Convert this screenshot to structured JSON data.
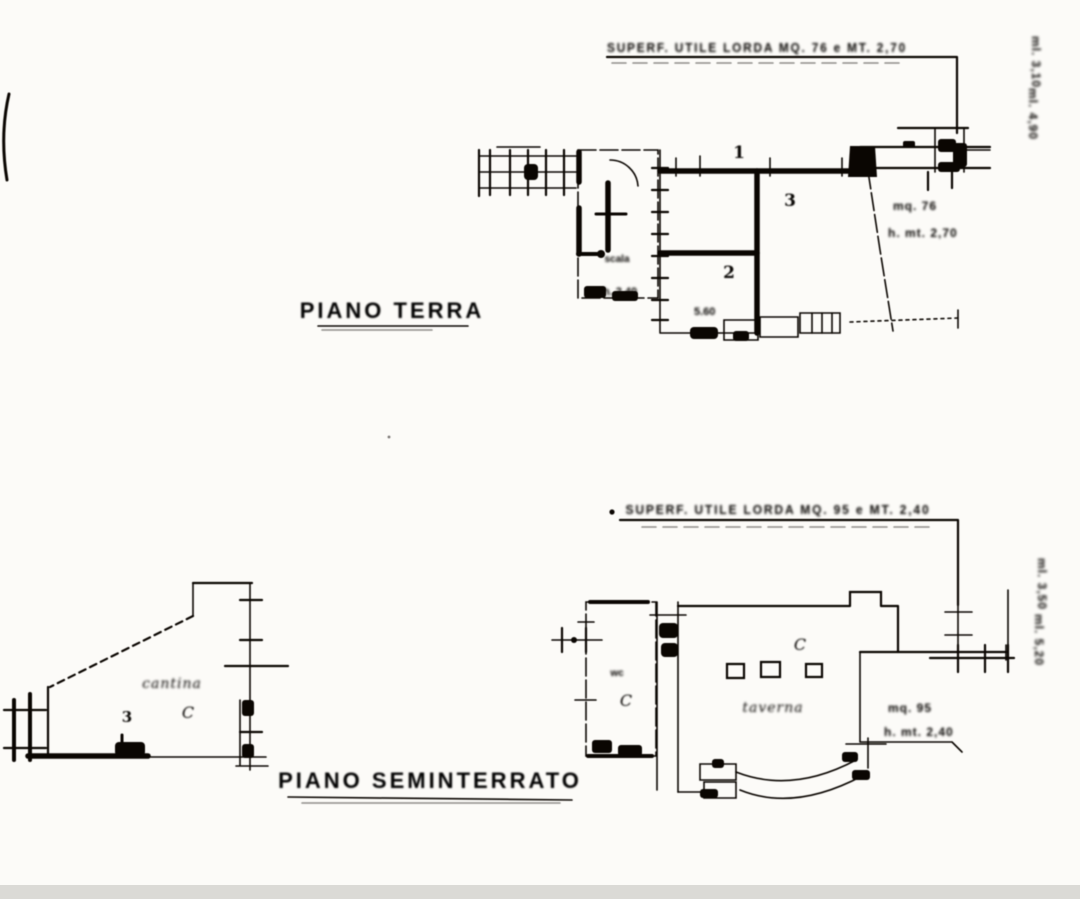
{
  "scan": {
    "background": "#fcfbf8",
    "ink": "#17130f"
  },
  "plans": {
    "ground_floor": {
      "label": "PIANO TERRA",
      "dimension_note": "SUPERF. UTILE LORDA MQ. 76 e MT. 2,70",
      "rooms": [
        {
          "number": "1"
        },
        {
          "number": "2"
        },
        {
          "number": "3"
        }
      ],
      "stair_note": "scala",
      "height_note": "h. 2,40",
      "floor_note": "5.60",
      "area_note_line1": "mq. 76",
      "area_note_line2": "h. mt. 2,70",
      "side_note_1": "ml. 3,10",
      "side_note_2": "ml. 4,90"
    },
    "basement": {
      "label": "PIANO SEMINTERRATO",
      "dimension_note": "SUPERF. UTILE LORDA MQ. 95 e MT. 2,40",
      "room_letter": "C",
      "room_word": "taverna",
      "wc_note": "wc",
      "wc_letter": "C",
      "area_note_line1": "mq. 95",
      "area_note_line2": "h. mt. 2,40",
      "side_note_1": "ml. 3,50",
      "side_note_2": "ml. 5,20"
    },
    "annex": {
      "word": "cantina",
      "number": "3",
      "letter": "C"
    }
  }
}
